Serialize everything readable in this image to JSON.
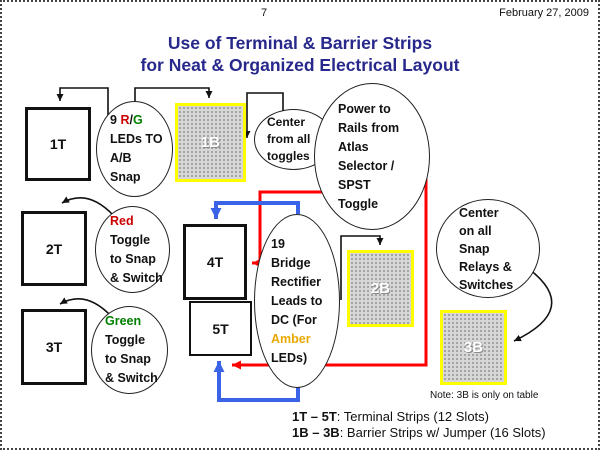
{
  "header": {
    "page_number": "7",
    "date": "February 27, 2009"
  },
  "title": {
    "line1": "Use of Terminal & Barrier Strips",
    "line2": "for Neat & Organized Electrical Layout"
  },
  "terminal_strips": {
    "t1": "1T",
    "t2": "2T",
    "t3": "3T",
    "t4": "4T",
    "t5": "5T"
  },
  "barrier_strips": {
    "b1": "1B",
    "b2": "2B",
    "b3": "3B"
  },
  "callouts": {
    "leds": {
      "prefix": "9 ",
      "red": "R",
      "slash": "/",
      "green": "G",
      "line2": "LEDs TO",
      "line3": "A/B",
      "line4": "Snap"
    },
    "red_toggle": {
      "colored": "Red",
      "line2": "Toggle",
      "line3": "to Snap",
      "line4": "& Switch"
    },
    "green_toggle": {
      "colored": "Green",
      "line2": "Toggle",
      "line3": "to Snap",
      "line4": "& Switch"
    },
    "center_toggles": {
      "line1": "Center",
      "line2": "from all",
      "line3": "toggles"
    },
    "power_rails": {
      "line1": "Power to",
      "line2": "Rails from",
      "line3": "Atlas",
      "line4": "Selector /",
      "line5": "SPST",
      "line6": "Toggle"
    },
    "bridge_rectifier": {
      "line1": "19",
      "line2": "Bridge",
      "line3": "Rectifier",
      "line4": "Leads to",
      "line5": "DC (For",
      "amber": "Amber",
      "line7": "LEDs)"
    },
    "center_snap": {
      "line1": "Center",
      "line2": "on all",
      "line3": "Snap",
      "line4": "Relays &",
      "line5": "Switches"
    }
  },
  "note": "Note: 3B is only on table",
  "legend": {
    "row1": {
      "bold": "1T – 5T",
      "rest": ":  Terminal Strips (12 Slots)"
    },
    "row2": {
      "bold": "1B – 3B",
      "rest": ":  Barrier Strips w/ Jumper (16 Slots)"
    }
  },
  "colors": {
    "title_navy": "#28288C",
    "red_wire": "#FF0000",
    "blue_wire": "#3B63E8",
    "barrier_border_yellow": "#FFFF00",
    "red_text": "#CC0000",
    "green_text": "#008000",
    "amber_text": "#E8A800"
  }
}
